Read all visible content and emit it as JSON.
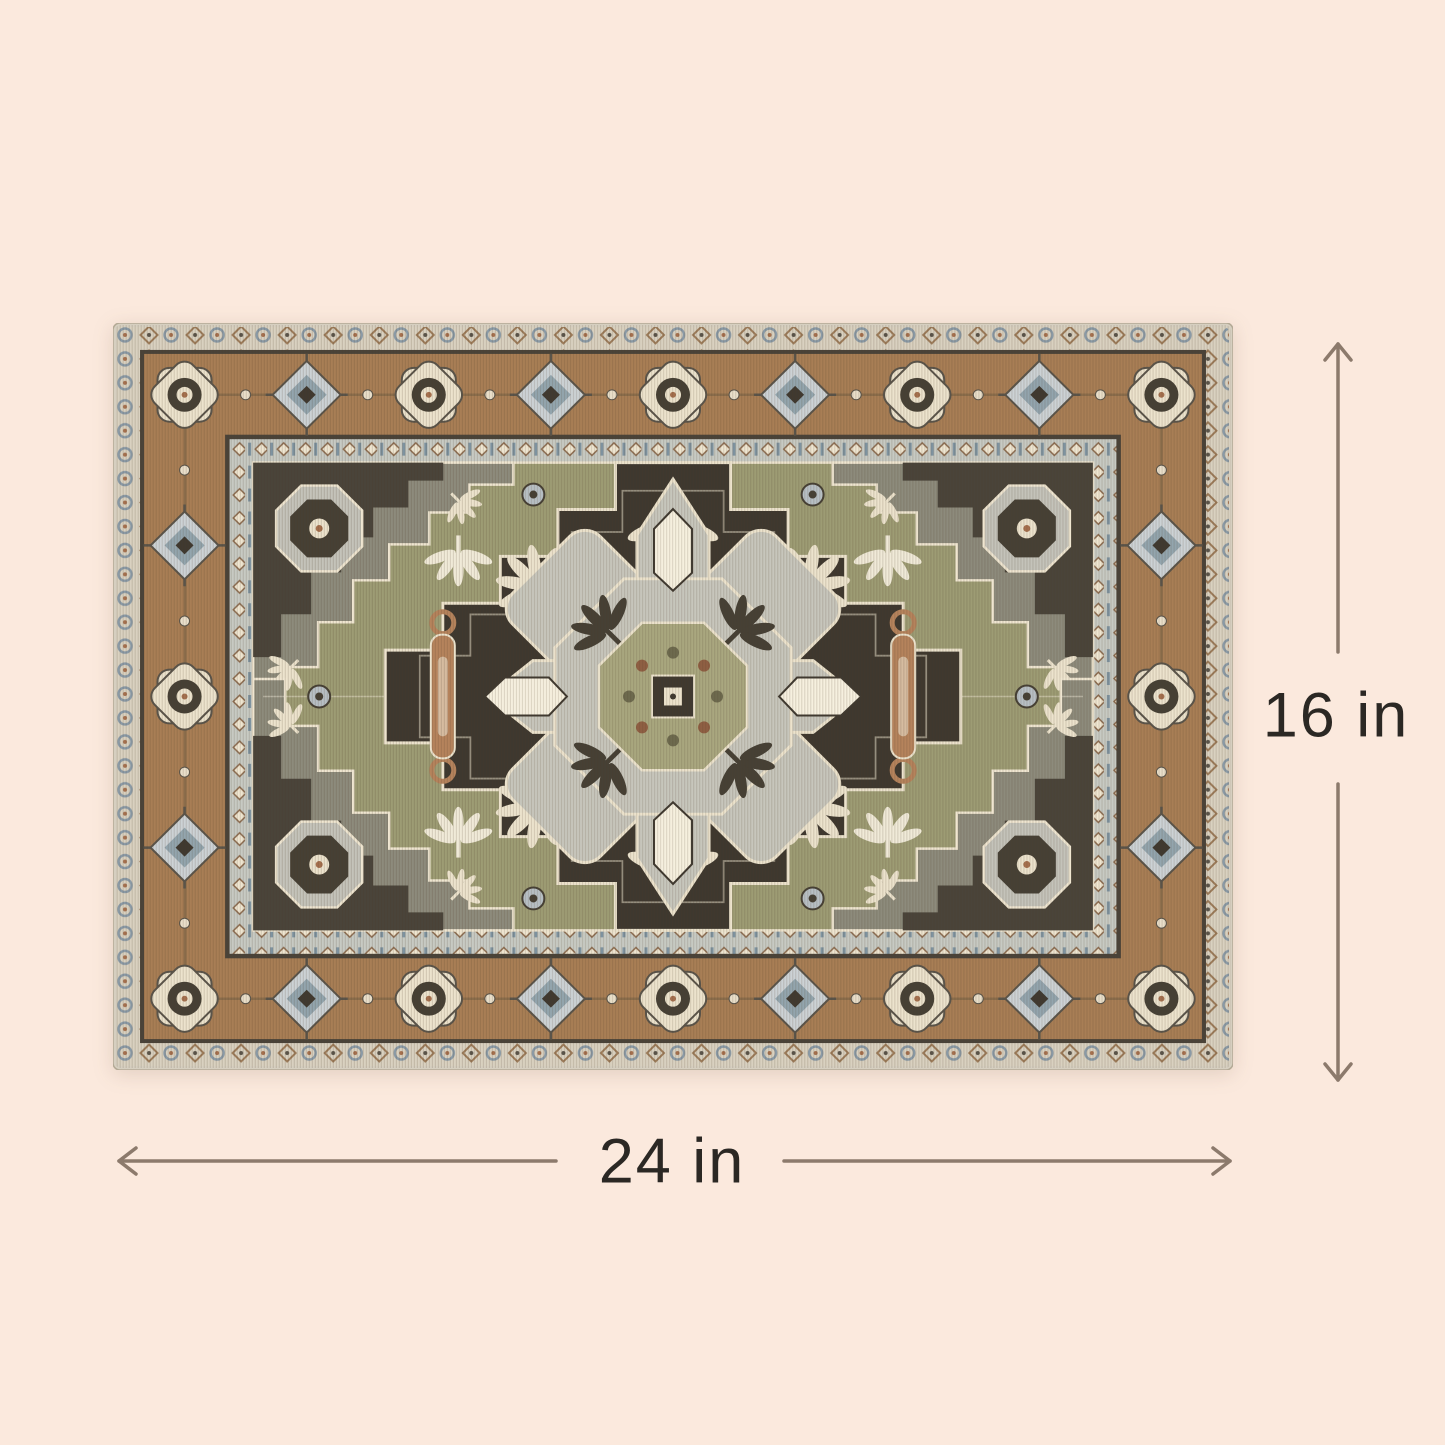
{
  "page": {
    "background_color": "#fbe9dd",
    "content": "product-dimension-diagram"
  },
  "dimensions": {
    "height": {
      "label": "16 in"
    },
    "width": {
      "label": "24 in"
    },
    "line_color": "#8c7a6c",
    "label_color": "#2b2824"
  },
  "rug": {
    "palette": {
      "binding": "#d6cfc0",
      "outer_guard_bg": "#d9d1c0",
      "main_border_camel": "#a87e55",
      "inner_guard_bg": "#c7cac3",
      "field_olive": "#9d9c74",
      "medallion_field_dark": "#3e382f",
      "motif_cream": "#ece3cd",
      "motif_white": "#f6f0df",
      "motif_gray": "#c7c6bc",
      "spandrel_gray": "#8d8b7c",
      "spandrel_dark": "#4a443a",
      "accent_blue": "#8fa6b2",
      "accent_rust": "#a5704e",
      "pendant_tan": "#b5835c",
      "separator_dark": "#4a4339"
    }
  }
}
